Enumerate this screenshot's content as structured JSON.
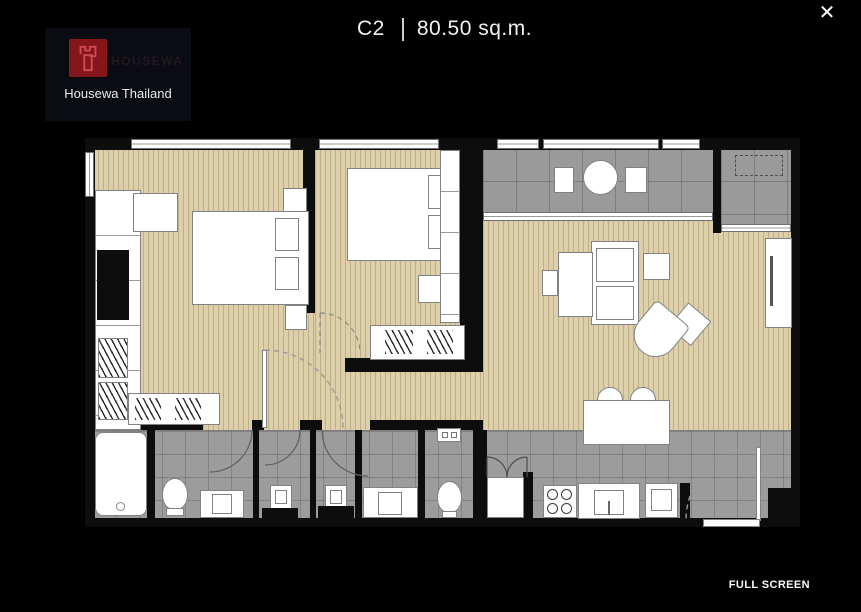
{
  "header": {
    "unit_code": "C2",
    "area_label": "80.50 sq.m."
  },
  "window_controls": {
    "close_icon": "✕"
  },
  "logo": {
    "brand": "HOUSEWA",
    "caption": "Housewa Thailand"
  },
  "viewer": {
    "fullscreen_label": "FULL SCREEN"
  },
  "floor_plan": {
    "unit_type": "C2",
    "area_sqm": "80.50"
  },
  "colors": {
    "background": "#000000",
    "plan_wall": "#0d0d0d",
    "wood_floor": "#dccfa9",
    "wood_grain": "#c8ba93",
    "tile_floor": "#9c9c9c",
    "tile_line": "#8b8b8b",
    "fixture_white": "#ffffff",
    "fixture_outline": "#828282",
    "logo_red": "#87161c",
    "logo_bg": "#0b0b12",
    "text_light": "#e8eaf0",
    "brand_dark": "#221820",
    "arc_gray": "#8a8a8a"
  }
}
